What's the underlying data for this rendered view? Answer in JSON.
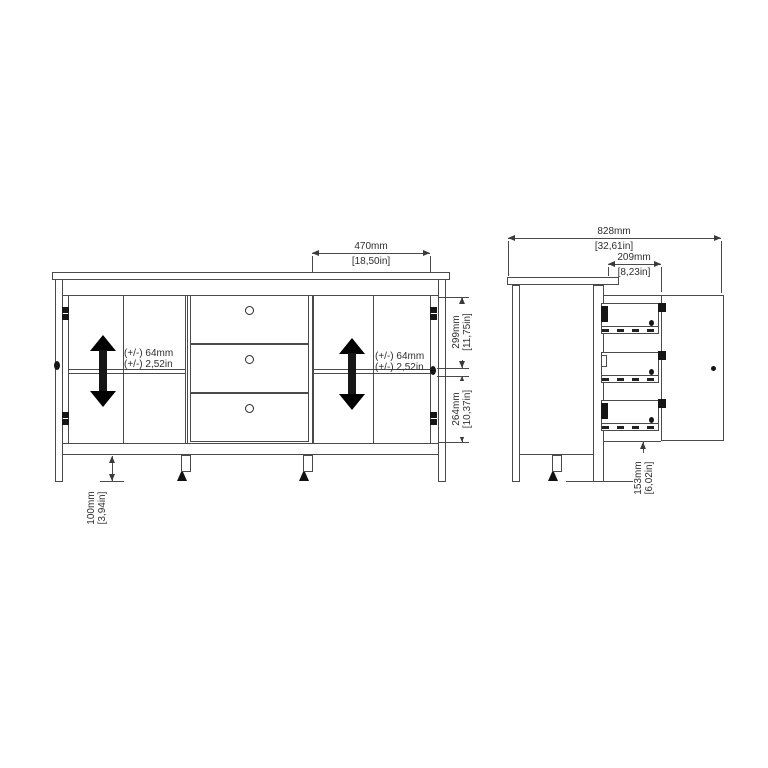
{
  "drawing": "furniture dimension diagram - sideboard with 2 doors and 3 drawers, front and side views",
  "colors": {
    "line": "#4a4a4a",
    "ink": "#161616",
    "text": "#2e2e2e",
    "background": "#ffffff"
  },
  "front_view": {
    "width_dim": {
      "mm": "470mm",
      "inch": "[18,50in]"
    },
    "upper_dim": {
      "mm": "299mm",
      "inch": "[11,75in]"
    },
    "lower_dim": {
      "mm": "264mm",
      "inch": "[10,37in]"
    },
    "leg_dim": {
      "mm": "100mm",
      "inch": "[3,94in]"
    },
    "left_shelf_note": {
      "line1": "(+/-) 64mm",
      "line2": "(+/-) 2,52in"
    },
    "right_shelf_note": {
      "line1": "(+/-) 64mm",
      "line2": "(+/-) 2,52in"
    }
  },
  "side_view": {
    "depth_dim": {
      "mm": "828mm",
      "inch": "[32,61in]"
    },
    "drawer_dim": {
      "mm": "209mm",
      "inch": "[8,23in]"
    },
    "leg_dim": {
      "mm": "153mm",
      "inch": "[6,02in]"
    }
  }
}
